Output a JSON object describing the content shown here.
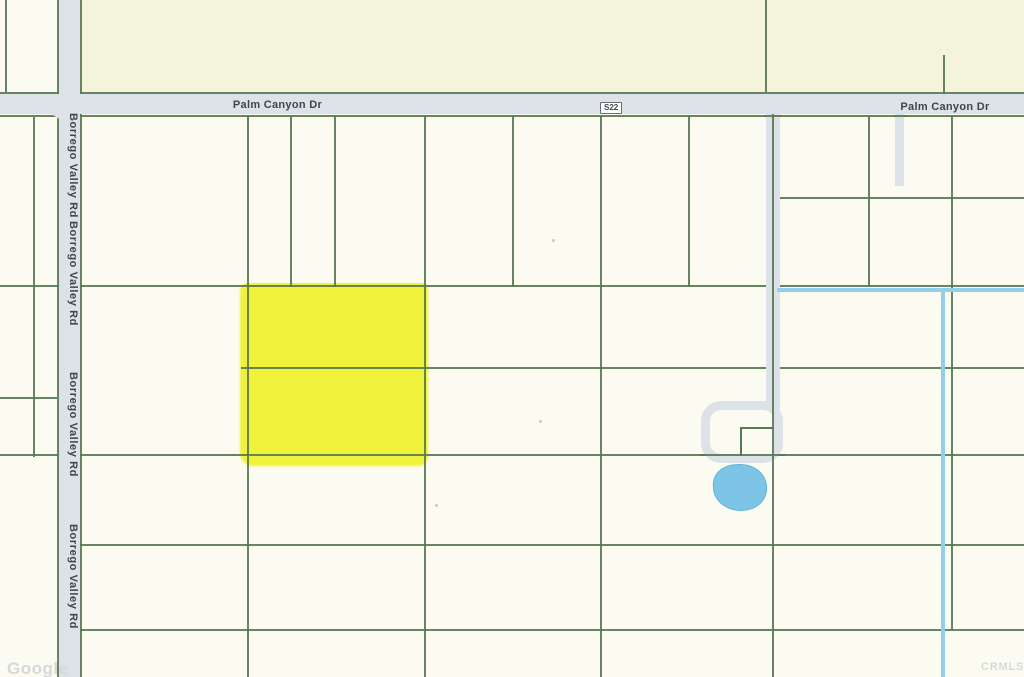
{
  "map": {
    "roads": {
      "palm_canyon_label_left": "Palm Canyon Dr",
      "palm_canyon_label_right": "Palm Canyon Dr",
      "route_shield": "S22",
      "borrego_labels": [
        "Borrego Valley Rd",
        "Borrego Valley Rd",
        "Borrego Valley Rd",
        "Borrego Valley Rd"
      ]
    },
    "watermarks": {
      "google": "Google",
      "crmls": "CRMLS"
    },
    "colors": {
      "background": "#fbfbf2",
      "beige": "#f3f4da",
      "road_fill": "#dce2e7",
      "parcel_line": "#567852",
      "water_line": "#90d0ea",
      "pond_fill": "#7cc5e6",
      "pond_border": "#64b4d8",
      "highlight": "#f0f12b",
      "label_text": "#3f464a",
      "watermark_text": "#d8d8d8",
      "shield_border": "#686d70"
    }
  }
}
